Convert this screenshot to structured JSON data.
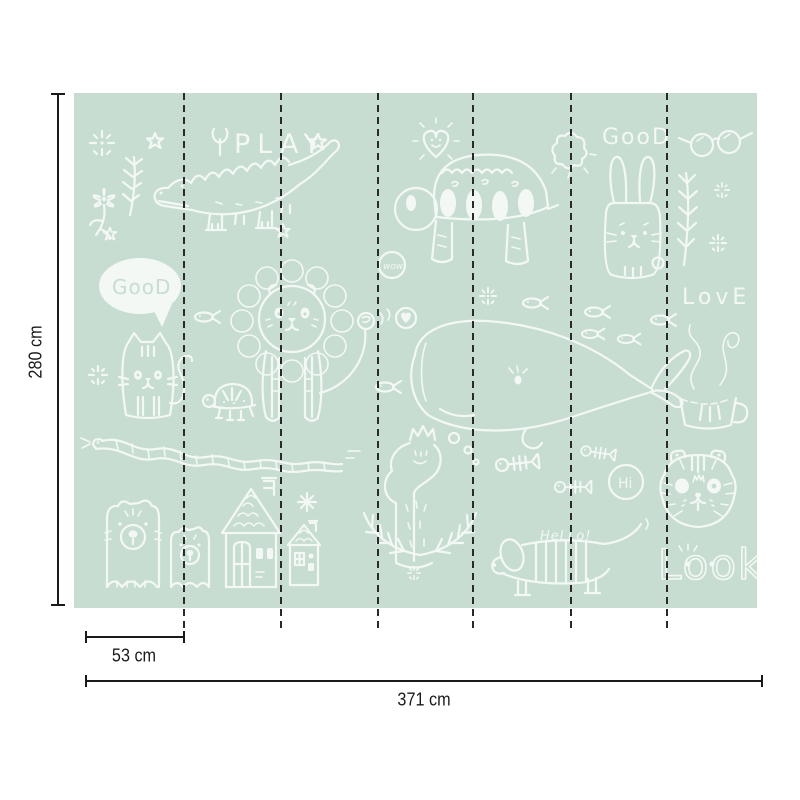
{
  "diagram": {
    "type": "wallpaper mural size diagram",
    "colors": {
      "background": "#ffffff",
      "mural_green": "#c7ddd1",
      "doodle_white": "#f3f8f4",
      "dimension_ink": "#1a1a1a",
      "seam_ink": "#2a2a2a"
    },
    "panels": {
      "count": 7,
      "seam_count": 6,
      "seam_style": "dashed"
    },
    "dimensions": {
      "height": "280 cm",
      "panel_width": "53 cm",
      "total_width": "371 cm"
    }
  },
  "artwork": {
    "words": {
      "play": "PLAY",
      "good_top": "GooD",
      "good_bubble": "GooD",
      "wow": "wow",
      "love": "LovE",
      "hi": "Hi",
      "hello": "HeLLo!",
      "look": "Look"
    },
    "motifs": [
      "crocodile",
      "big turtle",
      "small turtle",
      "lion",
      "cat",
      "rabbit",
      "whale",
      "snake",
      "big bear",
      "small bear",
      "big house",
      "small house",
      "dachshund dog",
      "tiger",
      "swan with crown",
      "fish",
      "fish bones",
      "teacup with steam",
      "glasses",
      "heart with face",
      "heart badge",
      "speech bubble",
      "stars",
      "sparkles",
      "flowers",
      "branches",
      "laurel"
    ]
  }
}
